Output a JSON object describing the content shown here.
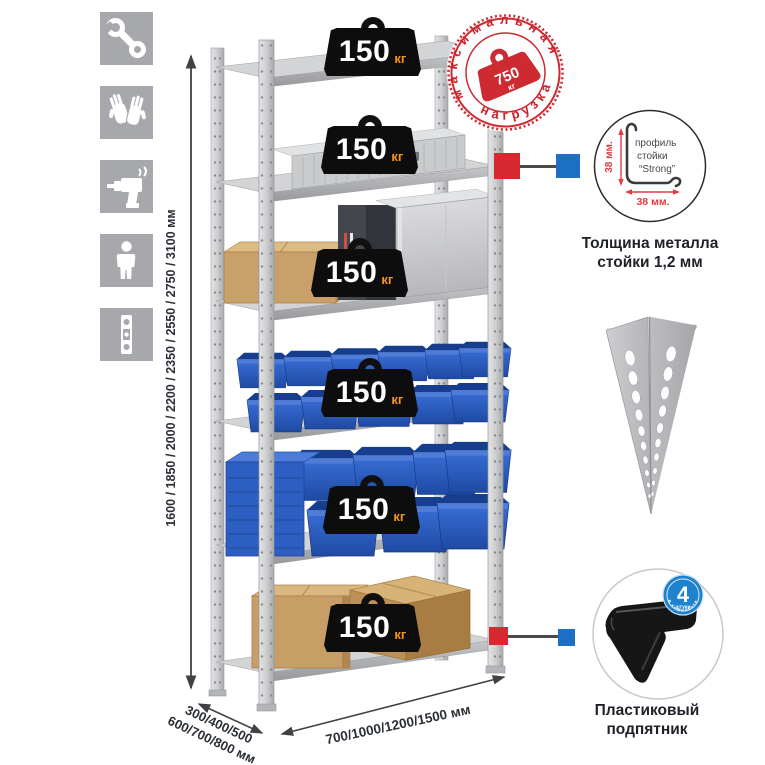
{
  "colors": {
    "stamp_red": "#cd2a31",
    "callout_red": "#d7282f",
    "callout_blue": "#1c6fc2",
    "unit_orange": "#f7941d",
    "bin_blue": "#2b5cc0",
    "icon_tile_gray": "#a6a8ab"
  },
  "toolbar_icons": [
    {
      "name": "wrench"
    },
    {
      "name": "gloves"
    },
    {
      "name": "drill"
    },
    {
      "name": "person"
    },
    {
      "name": "spirit-level"
    }
  ],
  "dimensions": {
    "height": "1600 / 1850 / 2000 / 2200 / 2350 / 2550 / 2750 / 3100 мм",
    "depth_line1": "300/400/500",
    "depth_line2": "600/700/800 мм",
    "width": "700/1000/1200/1500 мм"
  },
  "shelf_badges": [
    {
      "value": "150",
      "unit": "кг"
    },
    {
      "value": "150",
      "unit": "кг"
    },
    {
      "value": "150",
      "unit": "кг"
    },
    {
      "value": "150",
      "unit": "кг"
    },
    {
      "value": "150",
      "unit": "кг"
    },
    {
      "value": "150",
      "unit": "кг"
    }
  ],
  "stamp": {
    "arc_top": "максимальная",
    "arc_bottom": "нагрузка",
    "weight_value": "750",
    "weight_unit": "кг"
  },
  "profile": {
    "label_line1": "профиль",
    "label_line2": "стойки",
    "label_line3": "“Strong”",
    "dim_vertical": "38 мм.",
    "dim_horizontal": "38 мм.",
    "caption_line1": "Толщина металла",
    "caption_line2": "стойки 1,2 мм"
  },
  "foot": {
    "count": "4",
    "count_word": "штуки",
    "count_arc": "в комплекте",
    "caption_line1": "Пластиковый",
    "caption_line2": "подпятник"
  }
}
